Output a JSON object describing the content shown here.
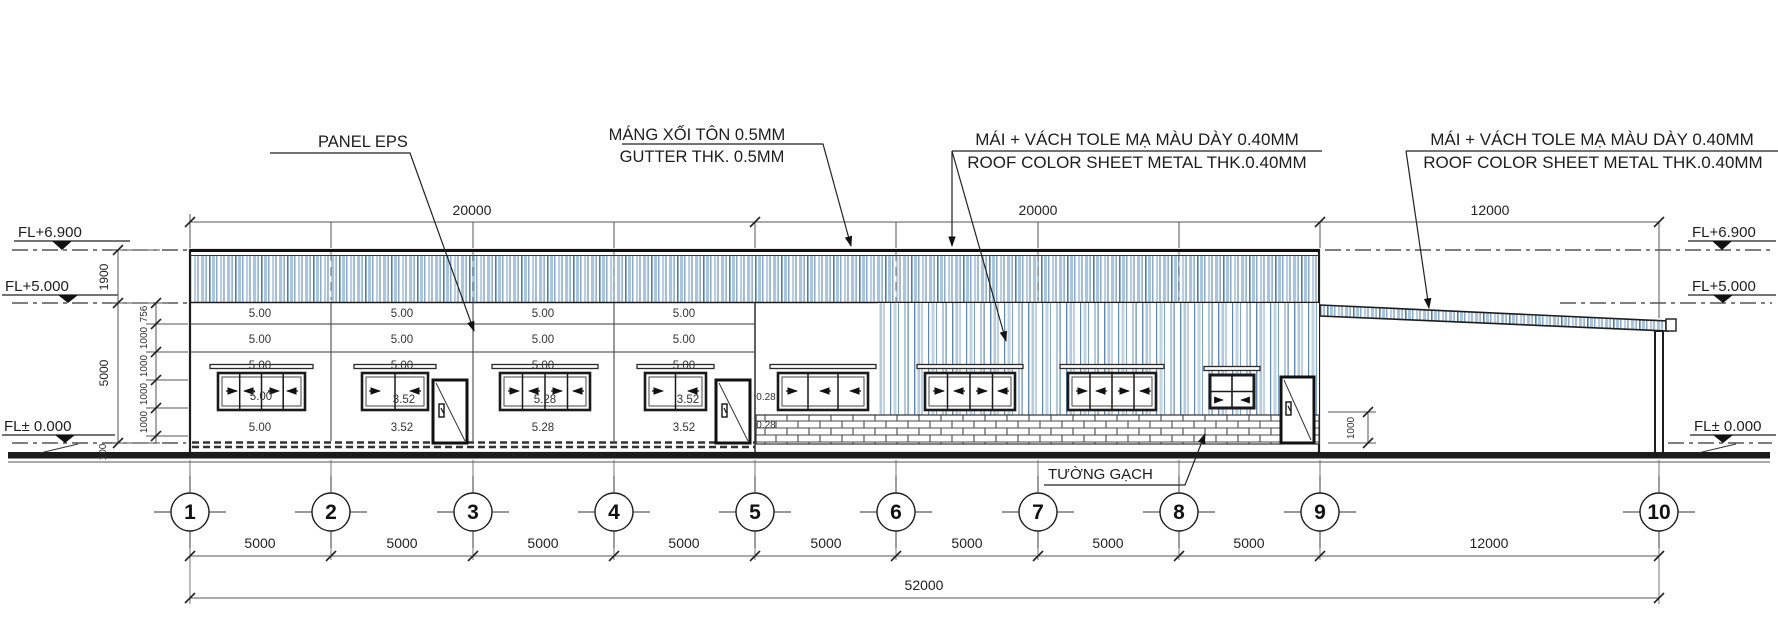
{
  "drawing": {
    "annotations": {
      "panel_eps": "PANEL EPS",
      "gutter_vi": "MÁNG XỐI TÔN 0.5MM",
      "gutter_en": "GUTTER THK. 0.5MM",
      "roof_wall_vi": "MÁI + VÁCH TOLE MẠ MÀU DÀY 0.40MM",
      "roof_wall_en": "ROOF COLOR SHEET METAL THK.0.40MM",
      "brick_wall": "TƯỜNG GẠCH"
    },
    "levels": {
      "roof": "FL+6.900",
      "eave": "FL+5.000",
      "ground": "FL± 0.000"
    },
    "dims": {
      "top": [
        "20000",
        "20000",
        "12000"
      ],
      "bottom": [
        "5000",
        "5000",
        "5000",
        "5000",
        "5000",
        "5000",
        "5000",
        "5000",
        "12000"
      ],
      "total": "52000",
      "left_outer": [
        "1900",
        "5000"
      ],
      "left_chain": [
        "756",
        "1000",
        "1000",
        "1000",
        "1000"
      ],
      "base_offset": "100",
      "brick_height": "1000",
      "door_dims": [
        "0.28",
        "0.28"
      ]
    },
    "grids": [
      "1",
      "2",
      "3",
      "4",
      "5",
      "6",
      "7",
      "8",
      "9",
      "10"
    ],
    "eps_panels": {
      "row1": [
        "5.00",
        "5.00",
        "5.00",
        "5.00"
      ],
      "row2": [
        "5.00",
        "5.00",
        "5.00",
        "5.00"
      ],
      "row3": [
        "5.00",
        "5.00",
        "5.00",
        "5.00"
      ],
      "window_row": [
        "5.00",
        "3.52",
        "5.28",
        "3.52"
      ],
      "base_row": [
        "5.00",
        "3.52",
        "5.28",
        "3.52"
      ]
    },
    "colors": {
      "stripe_dark": "#4f7ca6",
      "stripe_mid": "#6d96bb",
      "stripe_light": "#a9c6de",
      "line": "#1d1d1d",
      "dim_line": "#555555"
    }
  }
}
